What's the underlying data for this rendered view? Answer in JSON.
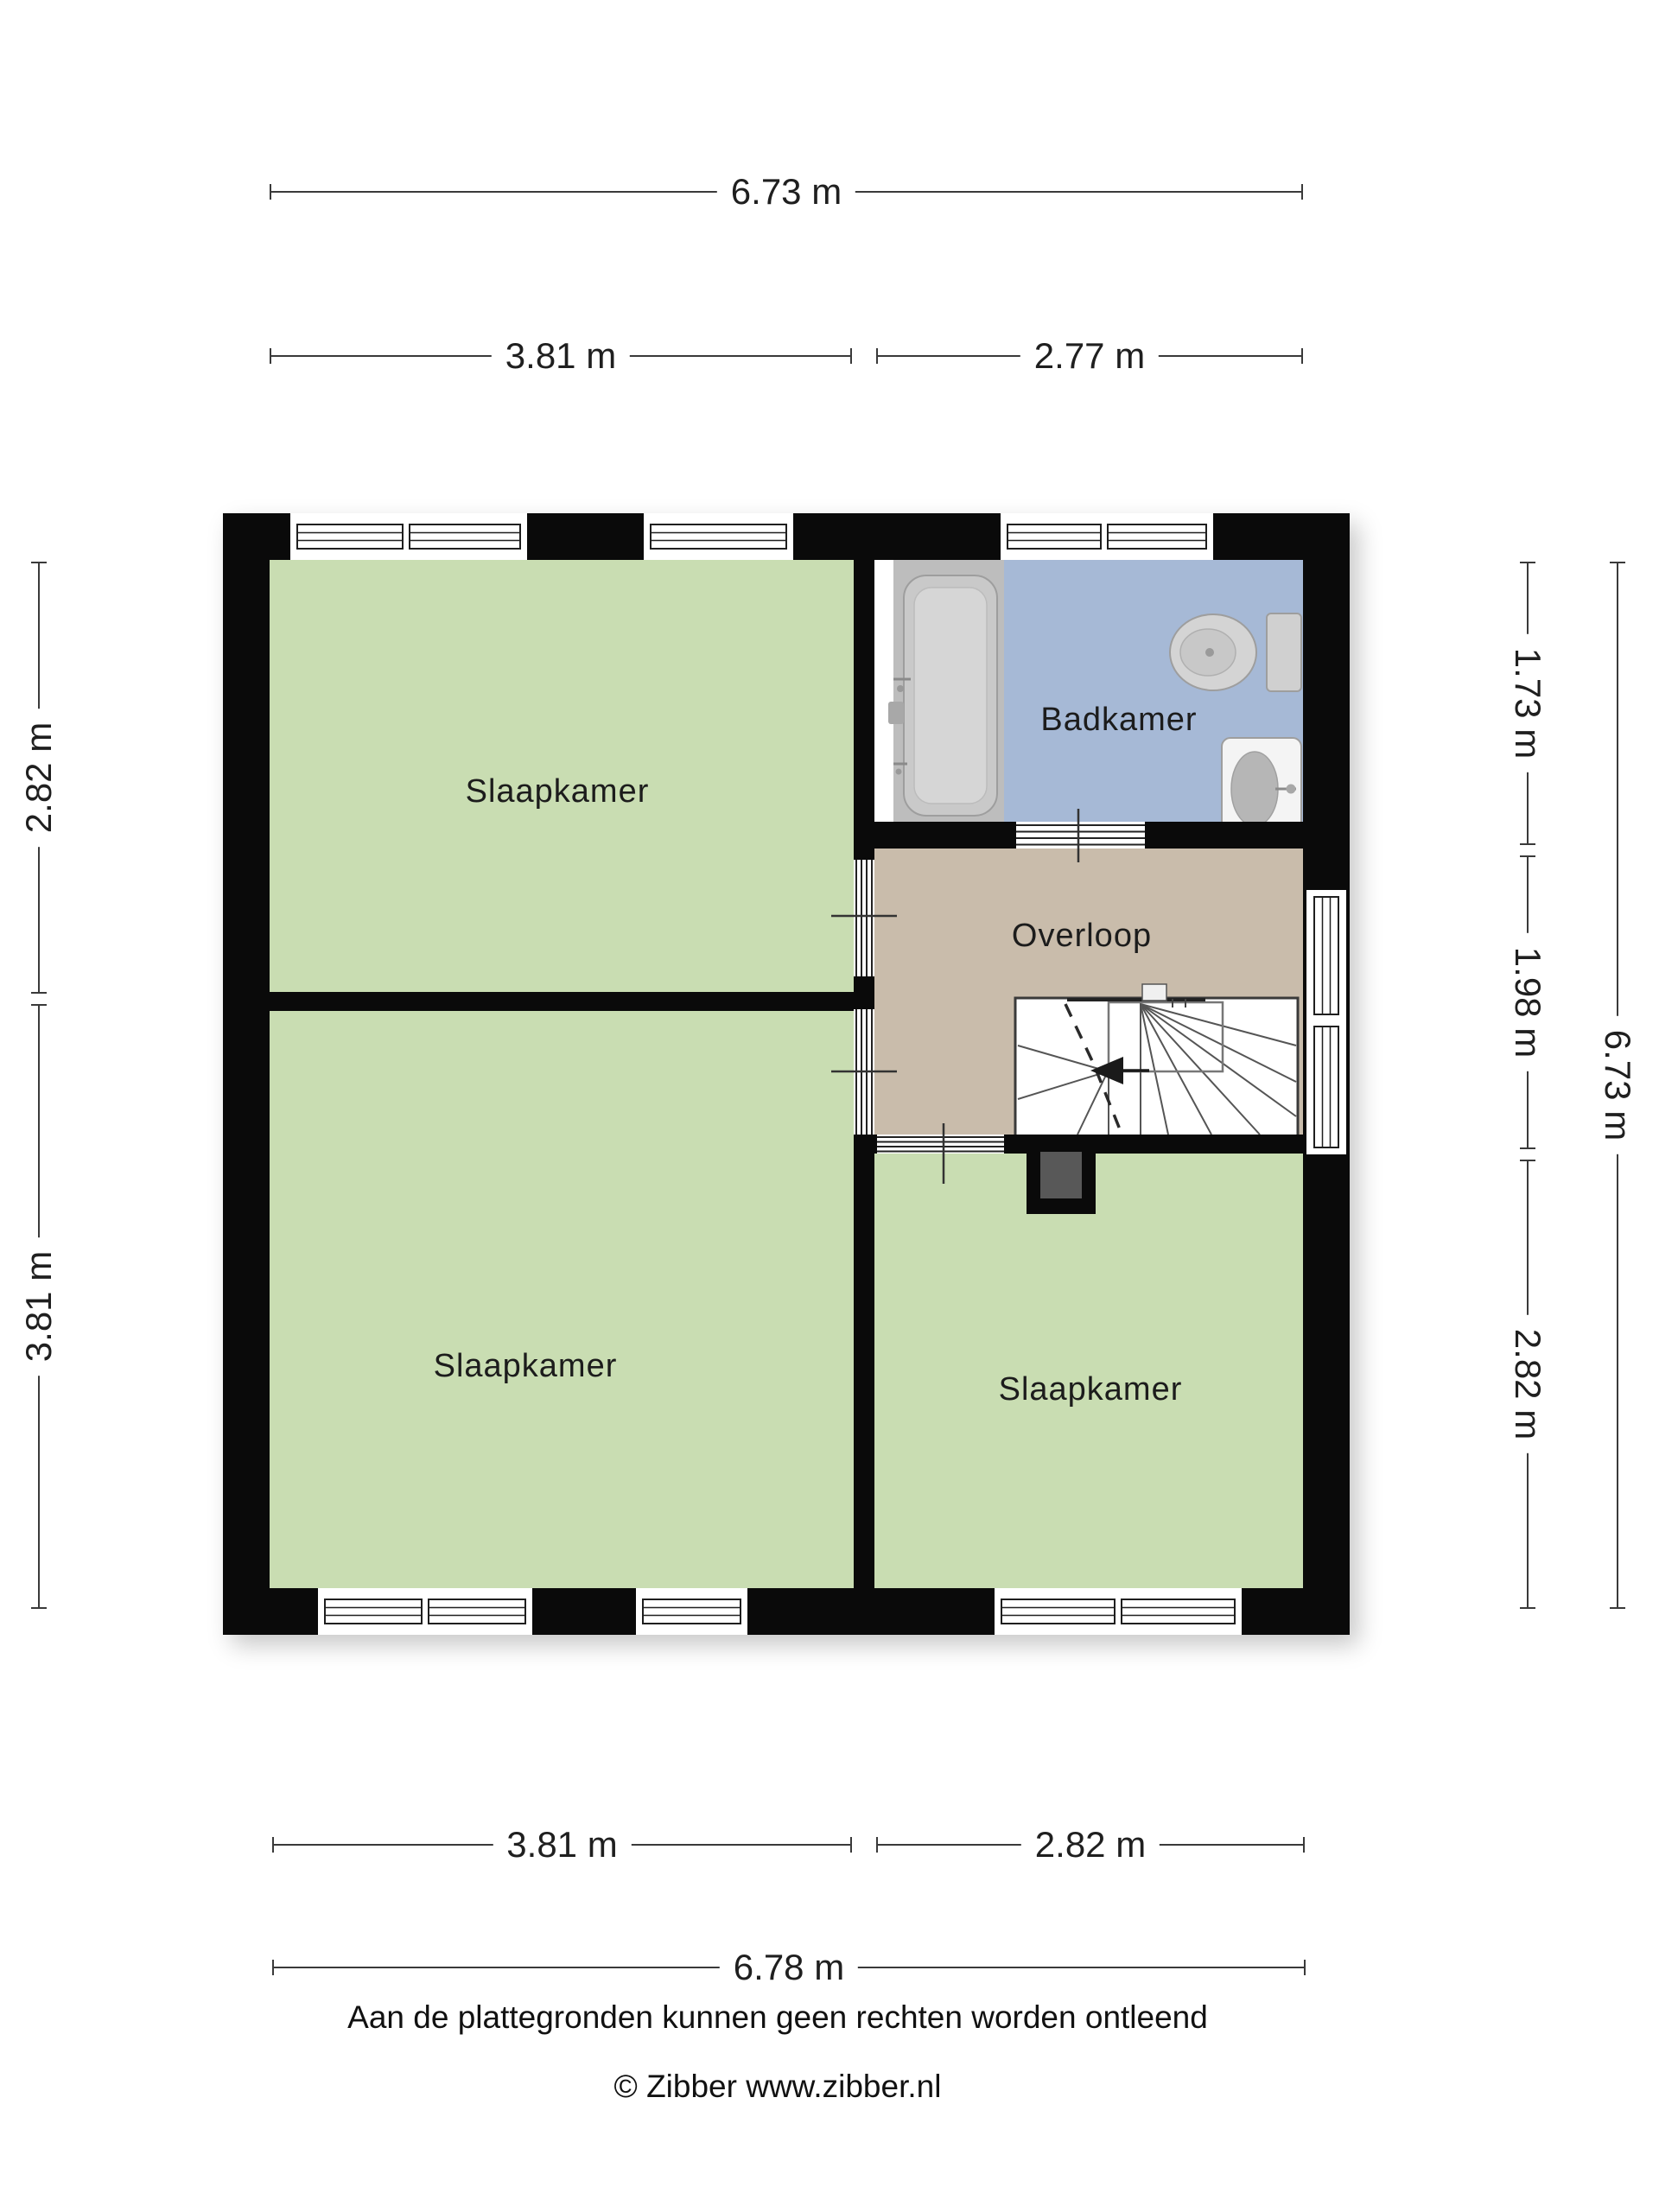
{
  "page": {
    "background": "#ffffff"
  },
  "colors": {
    "wall": "#0a0a0a",
    "floor_bedroom": "#c9ddb2",
    "floor_bathroom": "#a6b9d6",
    "floor_landing": "#c9bcab",
    "fixture_fill": "#d2d2d2",
    "chimney_inner": "#585858",
    "dimension_line": "#3a3a3a"
  },
  "rooms": {
    "bedroom_top_left": {
      "label": "Slaapkamer"
    },
    "bathroom": {
      "label": "Badkamer"
    },
    "landing": {
      "label": "Overloop"
    },
    "bedroom_bottom_left": {
      "label": "Slaapkamer"
    },
    "bedroom_bottom_right": {
      "label": "Slaapkamer"
    }
  },
  "fixtures": {
    "bathtub": "bathtub",
    "toilet": "toilet",
    "sink": "sink",
    "staircase": "winder staircase with down arrow",
    "chimney": "chimney"
  },
  "dimensions": {
    "top_total": "6.73 m",
    "top_left": "3.81 m",
    "top_right": "2.77 m",
    "left_upper": "2.82 m",
    "left_lower": "3.81 m",
    "right_upper": "1.73 m",
    "right_middle": "1.98 m",
    "right_lower": "2.82 m",
    "right_total": "6.73 m",
    "bottom_left": "3.81 m",
    "bottom_right": "2.82 m",
    "bottom_total": "6.78 m"
  },
  "footer": {
    "disclaimer": "Aan de plattegronden kunnen geen rechten worden ontleend",
    "copyright": "© Zibber www.zibber.nl"
  }
}
